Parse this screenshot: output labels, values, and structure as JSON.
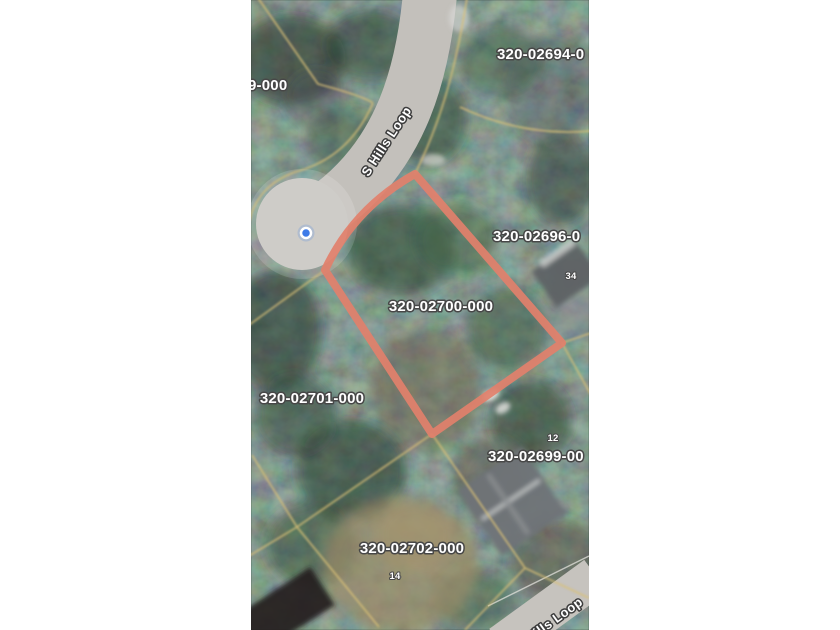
{
  "map": {
    "type": "satellite-parcel-map",
    "highlighted_parcel": "320-02700-000",
    "street": "S Hills Loop",
    "colors": {
      "parcel_highlight": "#e2806b",
      "parcel_line": "#d9c078",
      "marker_blue": "#3e7be8",
      "road_gray": "#c3c0bb",
      "culdesac_gray": "#c6c3bf"
    },
    "labels": {
      "p02694": "320-02694-0",
      "p9000": "9-000",
      "p02696": "320-02696-0",
      "p02700": "320-02700-000",
      "p02701": "320-02701-000",
      "p02699": "320-02699-00",
      "p02702": "320-02702-000",
      "n34": "34",
      "n12": "12",
      "n14": "14",
      "street_top": "S Hills Loop",
      "street_bottom": "S Hills Loop"
    }
  }
}
